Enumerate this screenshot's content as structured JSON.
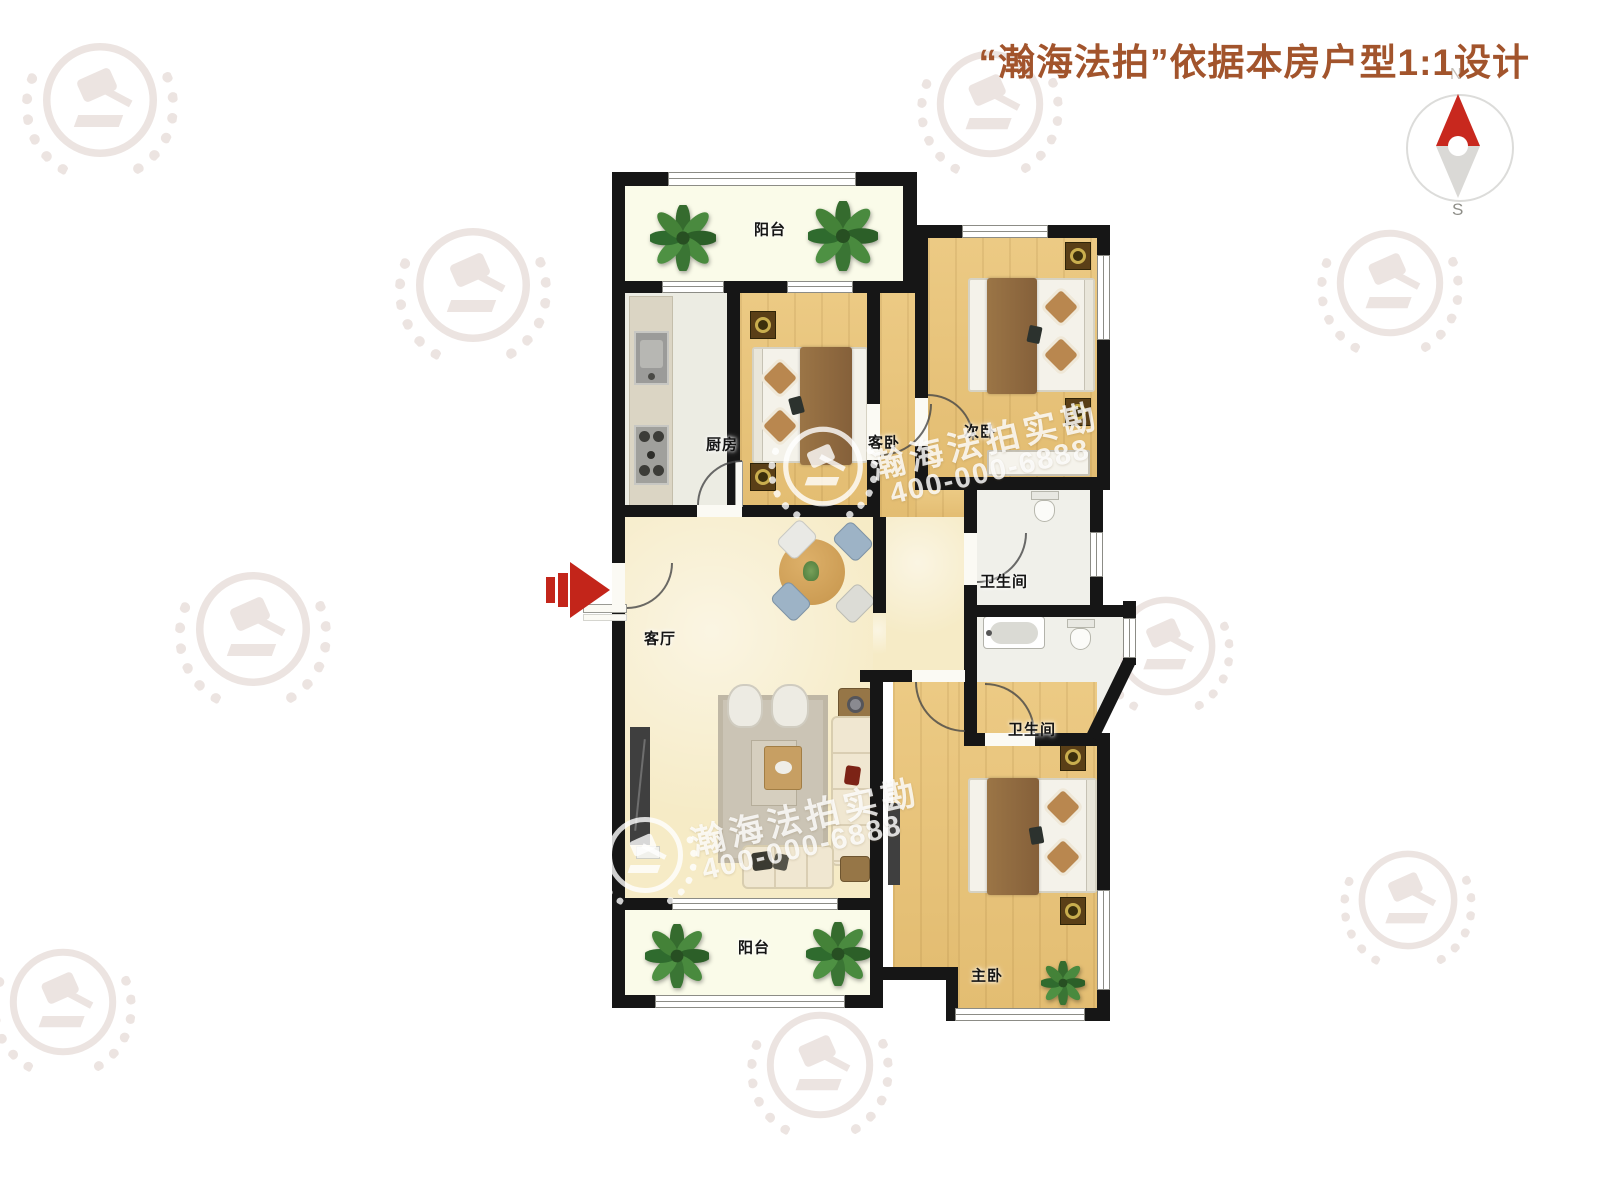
{
  "header": {
    "title": "“瀚海法拍”依据本房户型1:1设计"
  },
  "compass": {
    "north": "N",
    "south": "S"
  },
  "rooms": [
    {
      "id": "balcony-top",
      "label": "阳台"
    },
    {
      "id": "kitchen",
      "label": "厨房"
    },
    {
      "id": "guest-bedroom",
      "label": "客卧"
    },
    {
      "id": "second-bedroom",
      "label": "次卧"
    },
    {
      "id": "bathroom-1",
      "label": "卫生间"
    },
    {
      "id": "bathroom-2",
      "label": "卫生间"
    },
    {
      "id": "living-room",
      "label": "客厅"
    },
    {
      "id": "master-bedroom",
      "label": "主卧"
    },
    {
      "id": "balcony-bottom",
      "label": "阳台"
    }
  ],
  "watermark": {
    "brand": "瀚海法拍实勘",
    "phone": "400-000-6888"
  },
  "colors": {
    "title_brown": "#a2542c",
    "accent_red": "#c3251a",
    "wall": "#161616",
    "wood_floor": "#e8c67e",
    "living_floor": "#f6ebc6",
    "balcony_floor": "#fafbe9",
    "tile_floor": "#f0f0ea"
  }
}
